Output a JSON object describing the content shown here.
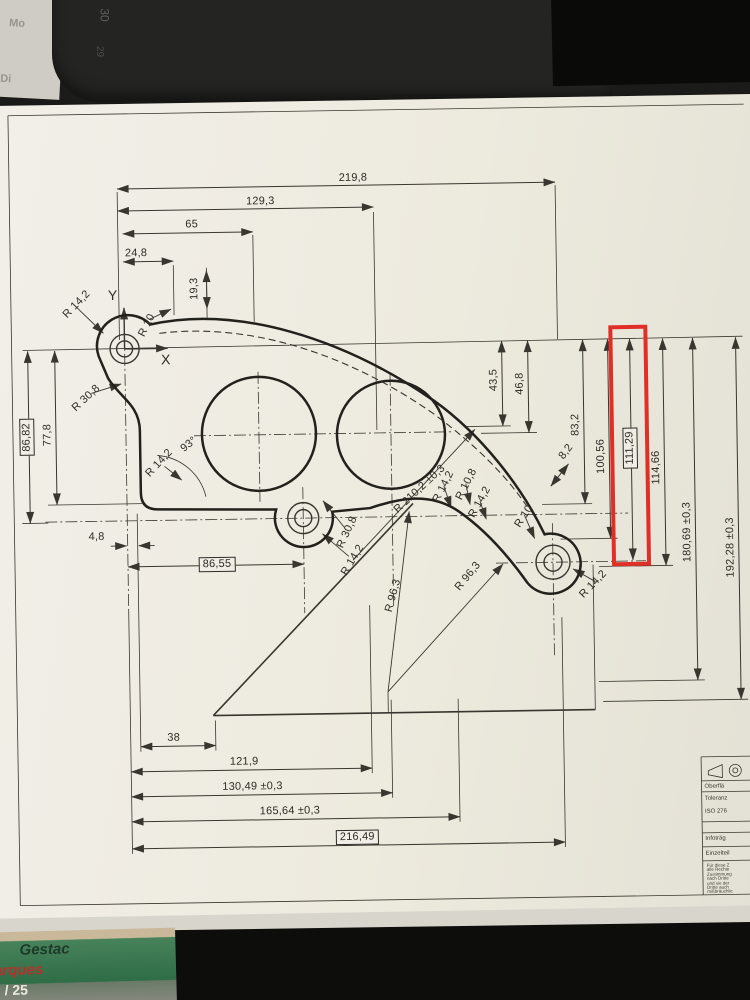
{
  "photo": {
    "background_objects": {
      "calendar_day_1": "Mo",
      "calendar_day_2": "Di",
      "calendar_number_1": "30",
      "calendar_number_2": "29",
      "package_text_1": "Gestac",
      "package_text_2": "arques",
      "package_text_3": "/ 25"
    }
  },
  "drawing": {
    "axes": {
      "x": "X",
      "y": "Y"
    },
    "angle_label": "93°",
    "dims": {
      "top": [
        "219,8",
        "129,3",
        "65",
        "24,8",
        "19,3"
      ],
      "left": [
        "86,82",
        "77,8",
        "4,8",
        "86,55"
      ],
      "right": [
        "43,5",
        "46,8",
        "83,2",
        "8,2",
        "100,56",
        "111,29",
        "114,66",
        "180,69 ±0,3",
        "192,28 ±0,3"
      ],
      "bottom": [
        "38",
        "121,9",
        "130,49 ±0,3",
        "165,64 ±0,3",
        "216,49"
      ]
    },
    "radii": [
      "R 14,2",
      "R 10",
      "R 30,8",
      "R 14,2",
      "R 30,8",
      "R 14,2",
      "R 210,2 ±0,3",
      "R 14,2",
      "R 10,8",
      "R 14,2",
      "R 10",
      "R 96,3",
      "R 96,3",
      "R 14,2"
    ],
    "highlight_color": "#e02f26"
  },
  "title_block": {
    "rows": [
      "Oberflä",
      "Toleranz",
      "ISO 276",
      "Infoträg",
      "Einzelteil"
    ],
    "fine_print": [
      "Für diese Z",
      "alle Rechte",
      "Zustimmung",
      "nach Dritte",
      "und sie der",
      "Dritte auch",
      "mißbräuchlic"
    ]
  }
}
